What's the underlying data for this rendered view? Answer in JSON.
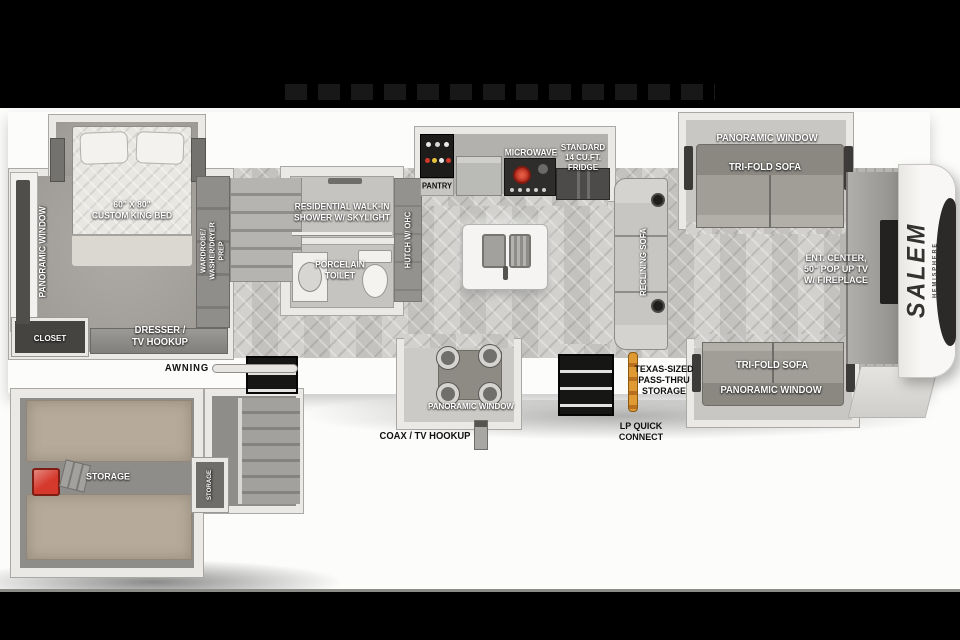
{
  "brand": {
    "name": "SALEM",
    "sub": "HEMISPHERE"
  },
  "colors": {
    "accent_red": "#c83527",
    "lp_orange": "#d98a2b",
    "storage_tan": "#b6aa9a",
    "floor_gray": "#cbcac7"
  },
  "labels": {
    "bedroom": {
      "window": "PANORAMIC WINDOW",
      "bed_l1": "60\" X 80\"",
      "bed_l2": "CUSTOM KING BED",
      "wardrobe_l1": "WARDROBE/",
      "wardrobe_l2": "WASHER/DRYER",
      "wardrobe_l3": "PREP",
      "closet": "CLOSET",
      "dresser_l1": "DRESSER /",
      "dresser_l2": "TV HOOKUP"
    },
    "bath": {
      "shower_l1": "RESIDENTIAL WALK-IN",
      "shower_l2": "SHOWER W/ SKYLIGHT",
      "toilet_l1": "PORCELAIN",
      "toilet_l2": "TOILET"
    },
    "kitchen": {
      "hutch": "HUTCH W/ OHC",
      "pantry": "PANTRY",
      "microwave": "MICROWAVE",
      "fridge_l1": "STANDARD",
      "fridge_l2": "14 CU.FT.",
      "fridge_l3": "FRIDGE"
    },
    "living": {
      "reclining": "RECLINING SOFA",
      "top_window": "PANORAMIC WINDOW",
      "top_sofa": "TRI-FOLD SOFA",
      "ent_l1": "ENT. CENTER,",
      "ent_l2": "50\" POP UP TV",
      "ent_l3": "W/ FIREPLACE",
      "bottom_sofa": "TRI-FOLD SOFA",
      "bottom_window": "PANORAMIC WINDOW"
    },
    "dinette": {
      "window": "PANORAMIC WINDOW"
    },
    "exterior": {
      "awning": "AWNING",
      "coax": "COAX / TV HOOKUP",
      "pass_l1": "TEXAS-SIZED",
      "pass_l2": "PASS-THRU",
      "pass_l3": "STORAGE",
      "lp_l1": "LP QUICK",
      "lp_l2": "CONNECT"
    },
    "garage": {
      "storage": "STORAGE",
      "storage_small": "STORAGE"
    }
  }
}
